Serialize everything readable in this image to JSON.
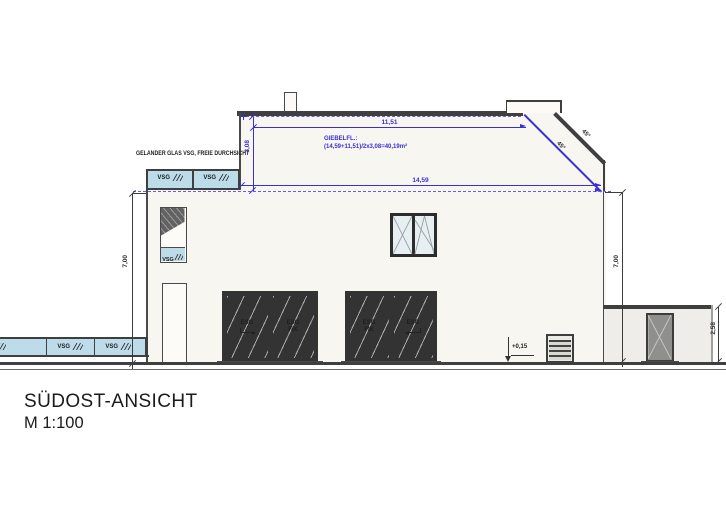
{
  "drawing": {
    "title": "SÜDOST-ANSICHT",
    "scale": "M 1:100"
  },
  "notes": {
    "railing": "GELÄNDER GLAS VSG, FREIE DURCHSICHT",
    "gable_area_label": "GIEBELFL.:",
    "gable_area_formula": "(14,59+11,51)/2x3,08=40,19m²",
    "level_marker": "+0,15"
  },
  "dims": {
    "upper_width": "11,51",
    "gable_height": "3,08",
    "lower_width": "14,59",
    "left_height": "7,00",
    "right_height": "7,00",
    "annex_height": "2,58",
    "roof_angle_inner": "45°",
    "roof_angle_outer": "45°"
  },
  "glass": {
    "railing_panels": [
      "VSG",
      "VSG"
    ],
    "band_panels": [
      "VSG",
      "VSG",
      "VSG"
    ],
    "stair_panel": "VSG",
    "door_left": [
      "ESG",
      "ESG FIX"
    ],
    "door_right": [
      "ESG FIX",
      "ESG"
    ]
  },
  "colors": {
    "dimension_blue": "#3c2fd2",
    "dashed_violet": "#6c5aea",
    "line_dark": "#3f3f3f",
    "facade": "#f7f6f0",
    "glass_blue": "#bcdce9",
    "door_glass": "#dce8ee",
    "annex_gray": "#eeedea"
  }
}
